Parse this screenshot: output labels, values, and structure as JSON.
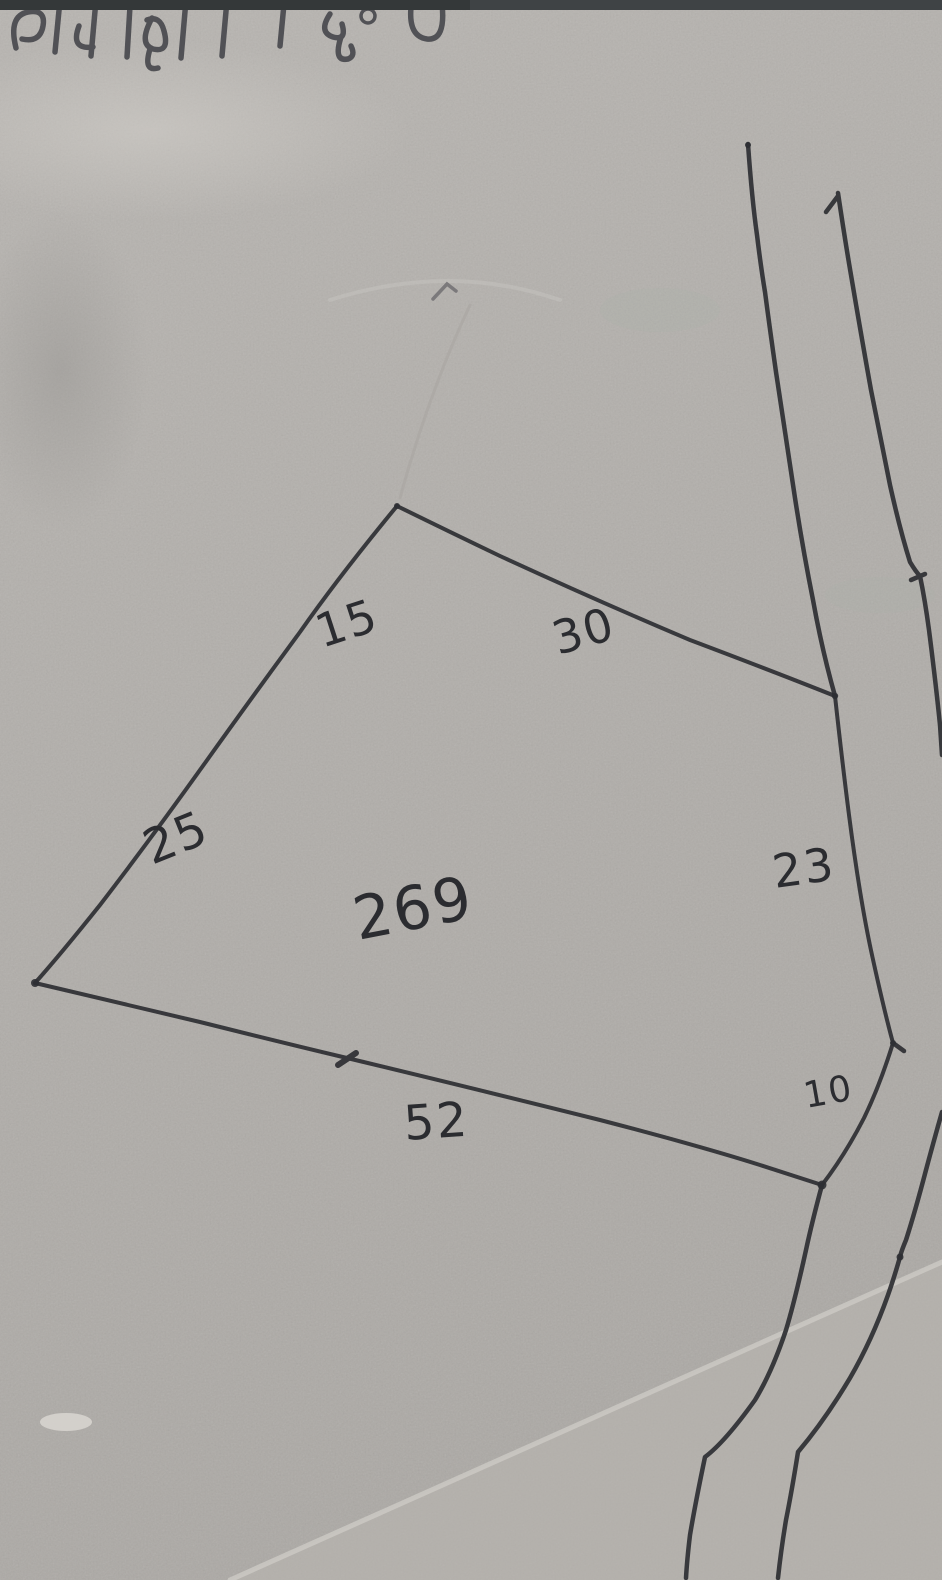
{
  "photo": {
    "heading_text": "शामला हि०ण",
    "plot_number": "269",
    "side_measurements": [
      {
        "side": "upper-west",
        "value": "15"
      },
      {
        "side": "north",
        "value": "30"
      },
      {
        "side": "lower-west",
        "value": "25"
      },
      {
        "side": "east",
        "value": "23"
      },
      {
        "side": "south",
        "value": "52"
      },
      {
        "side": "south-east",
        "value": "10"
      }
    ],
    "colors": {
      "paper": "#b3b0ac",
      "ink": "#2e2f33",
      "red_ink": "#9c3645",
      "top_strip": "#3c4042"
    }
  }
}
